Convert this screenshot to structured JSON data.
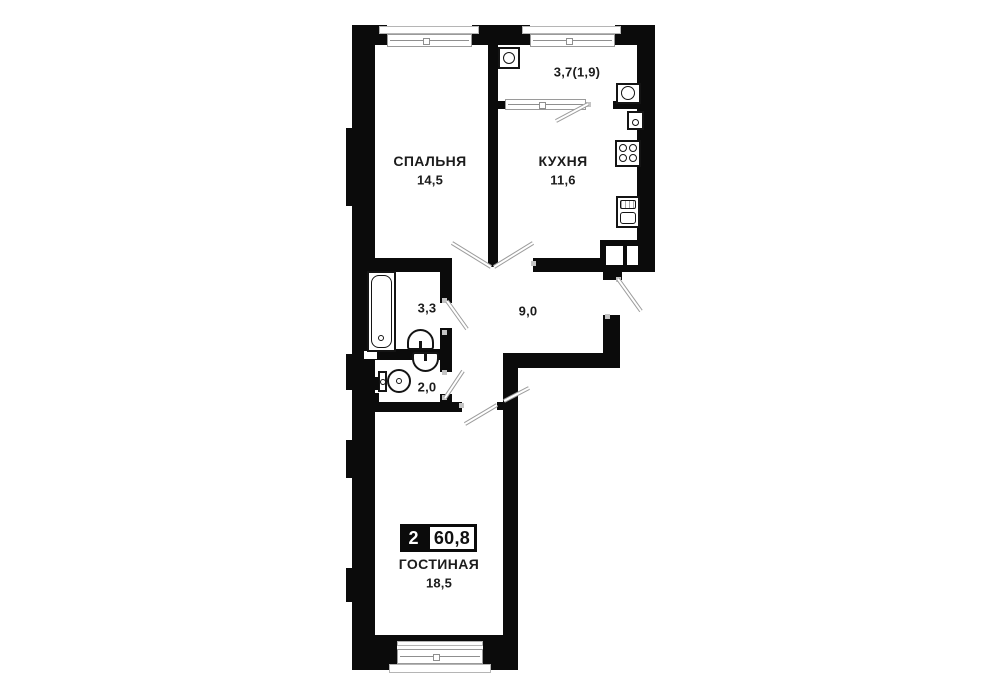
{
  "plan": {
    "type_badge": {
      "room_count": "2",
      "total_area": "60,8"
    },
    "rooms": [
      {
        "id": "bedroom",
        "name": "СПАЛЬНЯ",
        "area": "14,5"
      },
      {
        "id": "kitchen",
        "name": "КУХНЯ",
        "area": "11,6"
      },
      {
        "id": "balcony",
        "name": "",
        "area": "3,7(1,9)"
      },
      {
        "id": "bathroom",
        "name": "",
        "area": "3,3"
      },
      {
        "id": "hallway",
        "name": "",
        "area": "9,0"
      },
      {
        "id": "toilet",
        "name": "",
        "area": "2,0"
      },
      {
        "id": "living_room",
        "name": "ГОСТИНАЯ",
        "area": "18,5"
      }
    ],
    "fixtures": [
      "washing-machine-balcony",
      "washing-machine-balcony-right",
      "water-heater-kitchen",
      "stove-kitchen",
      "sink-kitchen",
      "bathtub",
      "wash-basin-bathroom",
      "wash-basin-toilet",
      "toilet-bowl",
      "vent-shaft",
      "vent-shaft"
    ],
    "colors": {
      "wall": "#0b0b0b",
      "background": "#ffffff",
      "door_line": "#9c9c9c",
      "window_frame": "#9a9a9a"
    }
  }
}
